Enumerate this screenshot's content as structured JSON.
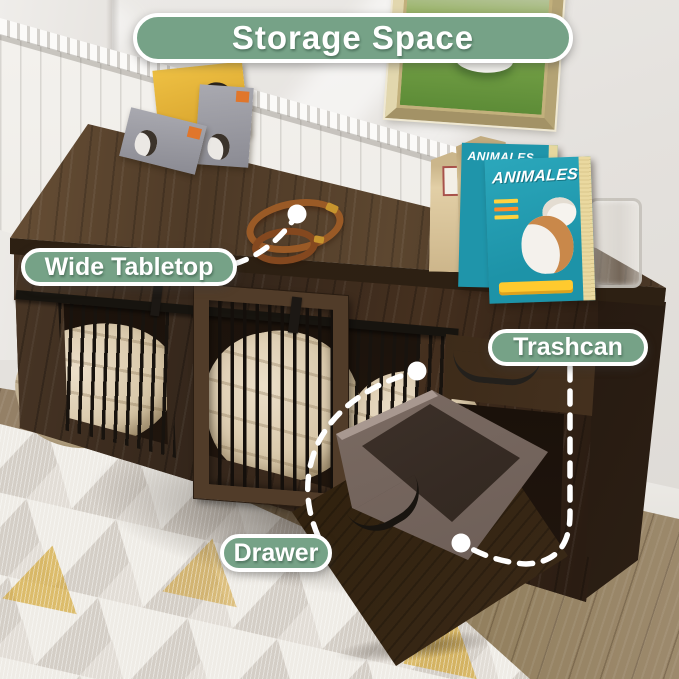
{
  "banner": {
    "title": "Storage Space"
  },
  "callouts": {
    "wide_tabletop": {
      "label": "Wide Tabletop"
    },
    "trashcan": {
      "label": "Trashcan"
    },
    "drawer": {
      "label": "Drawer"
    }
  },
  "props": {
    "magazine_title": "ANIMALES"
  },
  "colors": {
    "callout_bg": "#76A287",
    "callout_border": "#FFFFFF",
    "callout_text": "#FFFFFF",
    "annotation_white": "#FFFFFF",
    "wood_dark": "#3A2A1C",
    "magazine_teal": "#25A2B7",
    "rug_accent": "#D4A93C",
    "bin_brown": "#7D6D64"
  }
}
